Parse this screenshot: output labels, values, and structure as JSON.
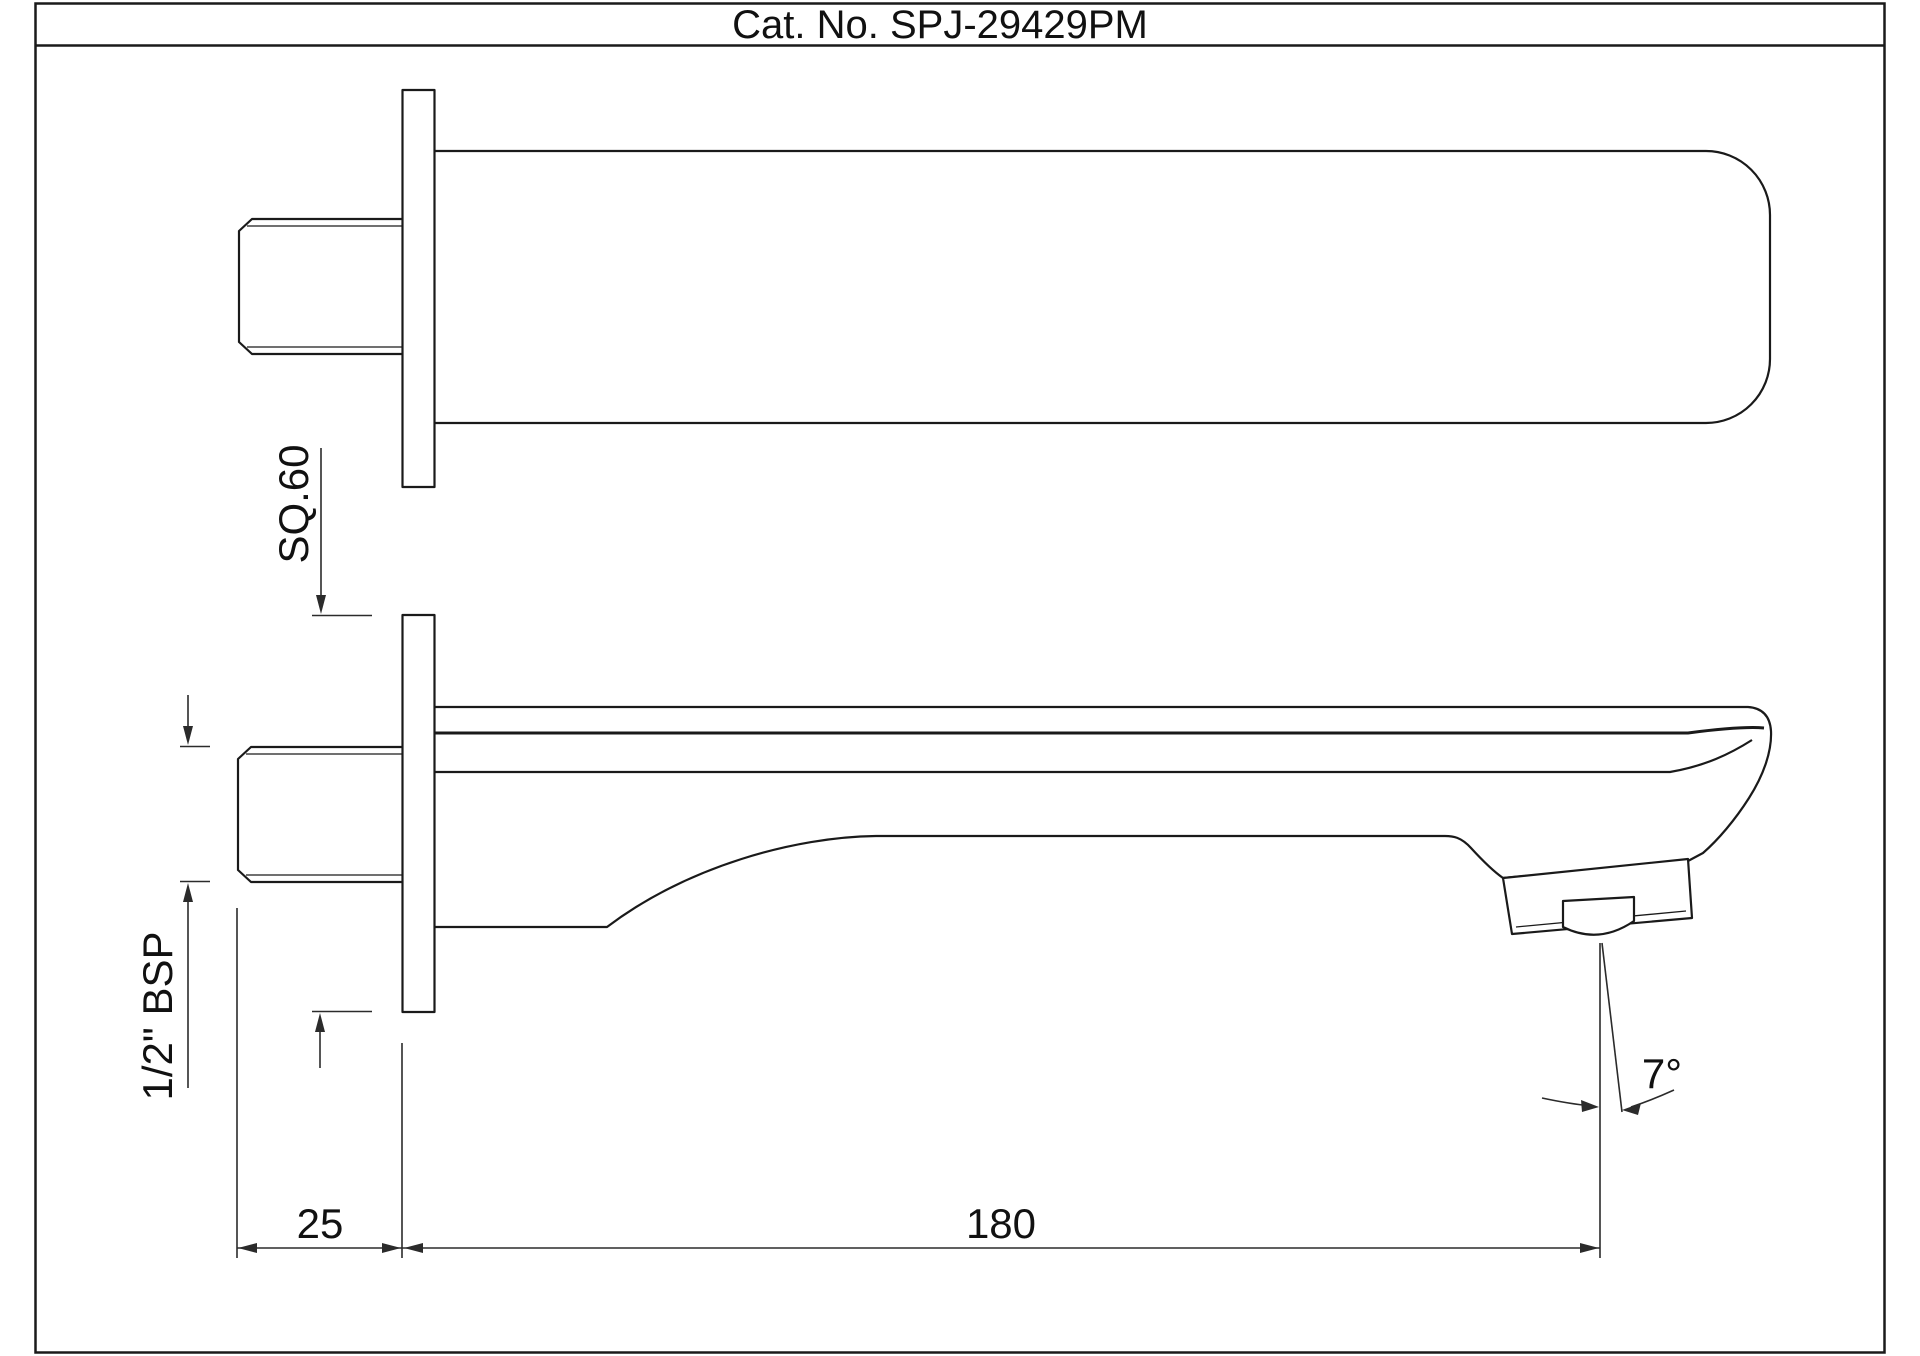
{
  "title": "Cat. No. SPJ-29429PM",
  "drawing": {
    "kind": "technical drawing - wall mounted bath spout, top view and side view",
    "dimensions": {
      "flange_square": "SQ.60",
      "thread": "1/2\" BSP",
      "wall_depth": "25",
      "spout_reach": "180",
      "spray_angle": "7°"
    },
    "colors": {
      "line_color": "#1a1a1a",
      "dimension_color": "#2b2b2b",
      "background": "#ffffff"
    }
  }
}
